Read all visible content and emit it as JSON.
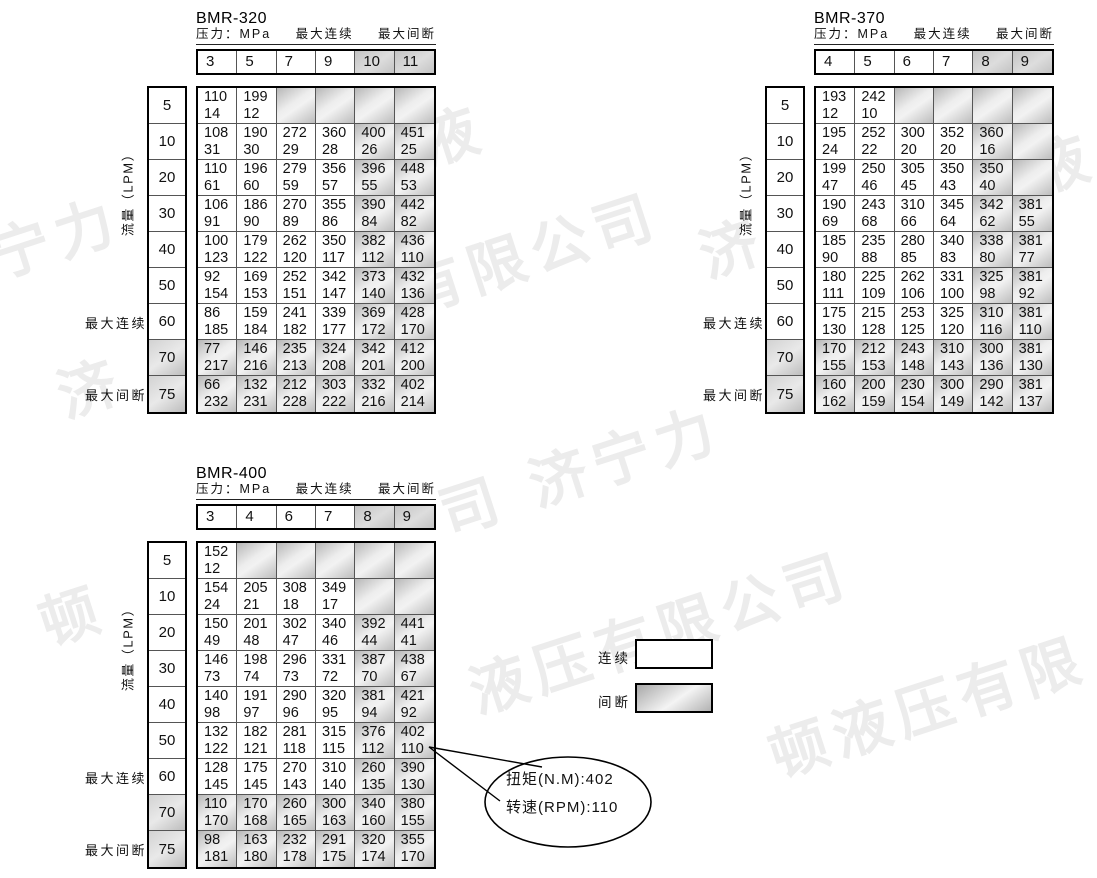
{
  "colors": {
    "table_border": "#000000",
    "grid_line": "#555555",
    "shade_gray": "#c3c3c3",
    "shade_light": "#f2f2f2",
    "watermark": "#ececec",
    "background": "#ffffff"
  },
  "watermark": {
    "text": "济宁力顿液压有限公司",
    "fragments": [
      {
        "text": "宁力",
        "left": -8,
        "top": 212
      },
      {
        "text": "济",
        "left": 58,
        "top": 352
      },
      {
        "text": "顿",
        "left": 40,
        "top": 580
      },
      {
        "text": "有限公司",
        "left": 405,
        "top": 248
      },
      {
        "text": "济",
        "left": 700,
        "top": 212
      },
      {
        "text": "液",
        "left": 420,
        "top": 100
      },
      {
        "text": "司 济宁力",
        "left": 440,
        "top": 470
      },
      {
        "text": "液压有限公司",
        "left": 470,
        "top": 648
      },
      {
        "text": "顿液压有限",
        "left": 770,
        "top": 712
      },
      {
        "text": "液",
        "left": 1030,
        "top": 128
      }
    ]
  },
  "legend": {
    "continuous_label": "连续",
    "intermittent_label": "间断"
  },
  "callout": {
    "line1": "扭矩(N.M):402",
    "line2": "转速(RPM):110"
  },
  "tables": [
    {
      "title": "BMR-320",
      "header": {
        "pressure": "压力：MPa",
        "continuous": "最大连续",
        "intermittent": "最大间断"
      },
      "flow_axis_label": "流量（LPM）",
      "left_labels": {
        "continuous": "最大连续",
        "intermittent": "最大间断"
      },
      "columns": [
        "3",
        "5",
        "7",
        "9",
        "10",
        "11"
      ],
      "shaded_columns": [
        4,
        5
      ],
      "rows": [
        {
          "flow": "5",
          "flow_shaded": false,
          "shaded": [
            2,
            3,
            4,
            5
          ],
          "cells": [
            [
              "110",
              "14"
            ],
            [
              "199",
              "12"
            ],
            null,
            null,
            null,
            null
          ]
        },
        {
          "flow": "10",
          "flow_shaded": false,
          "shaded": [
            4,
            5
          ],
          "cells": [
            [
              "108",
              "31"
            ],
            [
              "190",
              "30"
            ],
            [
              "272",
              "29"
            ],
            [
              "360",
              "28"
            ],
            [
              "400",
              "26"
            ],
            [
              "451",
              "25"
            ]
          ]
        },
        {
          "flow": "20",
          "flow_shaded": false,
          "shaded": [
            4,
            5
          ],
          "cells": [
            [
              "110",
              "61"
            ],
            [
              "196",
              "60"
            ],
            [
              "279",
              "59"
            ],
            [
              "356",
              "57"
            ],
            [
              "396",
              "55"
            ],
            [
              "448",
              "53"
            ]
          ]
        },
        {
          "flow": "30",
          "flow_shaded": false,
          "shaded": [
            4,
            5
          ],
          "cells": [
            [
              "106",
              "91"
            ],
            [
              "186",
              "90"
            ],
            [
              "270",
              "89"
            ],
            [
              "355",
              "86"
            ],
            [
              "390",
              "84"
            ],
            [
              "442",
              "82"
            ]
          ]
        },
        {
          "flow": "40",
          "flow_shaded": false,
          "shaded": [
            4,
            5
          ],
          "cells": [
            [
              "100",
              "123"
            ],
            [
              "179",
              "122"
            ],
            [
              "262",
              "120"
            ],
            [
              "350",
              "117"
            ],
            [
              "382",
              "112"
            ],
            [
              "436",
              "110"
            ]
          ]
        },
        {
          "flow": "50",
          "flow_shaded": false,
          "shaded": [
            4,
            5
          ],
          "cells": [
            [
              "92",
              "154"
            ],
            [
              "169",
              "153"
            ],
            [
              "252",
              "151"
            ],
            [
              "342",
              "147"
            ],
            [
              "373",
              "140"
            ],
            [
              "432",
              "136"
            ]
          ]
        },
        {
          "flow": "60",
          "flow_shaded": false,
          "shaded": [
            4,
            5
          ],
          "cells": [
            [
              "86",
              "185"
            ],
            [
              "159",
              "184"
            ],
            [
              "241",
              "182"
            ],
            [
              "339",
              "177"
            ],
            [
              "369",
              "172"
            ],
            [
              "428",
              "170"
            ]
          ]
        },
        {
          "flow": "70",
          "flow_shaded": true,
          "shaded": [
            0,
            1,
            2,
            3,
            4,
            5
          ],
          "cells": [
            [
              "77",
              "217"
            ],
            [
              "146",
              "216"
            ],
            [
              "235",
              "213"
            ],
            [
              "324",
              "208"
            ],
            [
              "342",
              "201"
            ],
            [
              "412",
              "200"
            ]
          ]
        },
        {
          "flow": "75",
          "flow_shaded": true,
          "shaded": [
            0,
            1,
            2,
            3,
            4,
            5
          ],
          "cells": [
            [
              "66",
              "232"
            ],
            [
              "132",
              "231"
            ],
            [
              "212",
              "228"
            ],
            [
              "303",
              "222"
            ],
            [
              "332",
              "216"
            ],
            [
              "402",
              "214"
            ]
          ]
        }
      ]
    },
    {
      "title": "BMR-370",
      "header": {
        "pressure": "压力：MPa",
        "continuous": "最大连续",
        "intermittent": "最大间断"
      },
      "flow_axis_label": "流量（LPM）",
      "left_labels": {
        "continuous": "最大连续",
        "intermittent": "最大间断"
      },
      "columns": [
        "4",
        "5",
        "6",
        "7",
        "8",
        "9"
      ],
      "shaded_columns": [
        4,
        5
      ],
      "rows": [
        {
          "flow": "5",
          "flow_shaded": false,
          "shaded": [
            2,
            3,
            4,
            5
          ],
          "cells": [
            [
              "193",
              "12"
            ],
            [
              "242",
              "10"
            ],
            null,
            null,
            null,
            null
          ]
        },
        {
          "flow": "10",
          "flow_shaded": false,
          "shaded": [
            4,
            5
          ],
          "cells": [
            [
              "195",
              "24"
            ],
            [
              "252",
              "22"
            ],
            [
              "300",
              "20"
            ],
            [
              "352",
              "20"
            ],
            [
              "360",
              "16"
            ],
            null
          ]
        },
        {
          "flow": "20",
          "flow_shaded": false,
          "shaded": [
            4,
            5
          ],
          "cells": [
            [
              "199",
              "47"
            ],
            [
              "250",
              "46"
            ],
            [
              "305",
              "45"
            ],
            [
              "350",
              "43"
            ],
            [
              "350",
              "40"
            ],
            null
          ]
        },
        {
          "flow": "30",
          "flow_shaded": false,
          "shaded": [
            4,
            5
          ],
          "cells": [
            [
              "190",
              "69"
            ],
            [
              "243",
              "68"
            ],
            [
              "310",
              "66"
            ],
            [
              "345",
              "64"
            ],
            [
              "342",
              "62"
            ],
            [
              "381",
              "55"
            ]
          ]
        },
        {
          "flow": "40",
          "flow_shaded": false,
          "shaded": [
            4,
            5
          ],
          "cells": [
            [
              "185",
              "90"
            ],
            [
              "235",
              "88"
            ],
            [
              "280",
              "85"
            ],
            [
              "340",
              "83"
            ],
            [
              "338",
              "80"
            ],
            [
              "381",
              "77"
            ]
          ]
        },
        {
          "flow": "50",
          "flow_shaded": false,
          "shaded": [
            4,
            5
          ],
          "cells": [
            [
              "180",
              "111"
            ],
            [
              "225",
              "109"
            ],
            [
              "262",
              "106"
            ],
            [
              "331",
              "100"
            ],
            [
              "325",
              "98"
            ],
            [
              "381",
              "92"
            ]
          ]
        },
        {
          "flow": "60",
          "flow_shaded": false,
          "shaded": [
            4,
            5
          ],
          "cells": [
            [
              "175",
              "130"
            ],
            [
              "215",
              "128"
            ],
            [
              "253",
              "125"
            ],
            [
              "325",
              "120"
            ],
            [
              "310",
              "116"
            ],
            [
              "381",
              "110"
            ]
          ]
        },
        {
          "flow": "70",
          "flow_shaded": true,
          "shaded": [
            0,
            1,
            2,
            3,
            4,
            5
          ],
          "cells": [
            [
              "170",
              "155"
            ],
            [
              "212",
              "153"
            ],
            [
              "243",
              "148"
            ],
            [
              "310",
              "143"
            ],
            [
              "300",
              "136"
            ],
            [
              "381",
              "130"
            ]
          ]
        },
        {
          "flow": "75",
          "flow_shaded": true,
          "shaded": [
            0,
            1,
            2,
            3,
            4,
            5
          ],
          "cells": [
            [
              "160",
              "162"
            ],
            [
              "200",
              "159"
            ],
            [
              "230",
              "154"
            ],
            [
              "300",
              "149"
            ],
            [
              "290",
              "142"
            ],
            [
              "381",
              "137"
            ]
          ]
        }
      ]
    },
    {
      "title": "BMR-400",
      "header": {
        "pressure": "压力：MPa",
        "continuous": "最大连续",
        "intermittent": "最大间断"
      },
      "flow_axis_label": "流量（LPM）",
      "left_labels": {
        "continuous": "最大连续",
        "intermittent": "最大间断"
      },
      "columns": [
        "3",
        "4",
        "6",
        "7",
        "8",
        "9"
      ],
      "shaded_columns": [
        4,
        5
      ],
      "rows": [
        {
          "flow": "5",
          "flow_shaded": false,
          "shaded": [
            1,
            2,
            3,
            4,
            5
          ],
          "cells": [
            [
              "152",
              "12"
            ],
            null,
            null,
            null,
            null,
            null
          ]
        },
        {
          "flow": "10",
          "flow_shaded": false,
          "shaded": [
            4,
            5
          ],
          "cells": [
            [
              "154",
              "24"
            ],
            [
              "205",
              "21"
            ],
            [
              "308",
              "18"
            ],
            [
              "349",
              "17"
            ],
            null,
            null
          ]
        },
        {
          "flow": "20",
          "flow_shaded": false,
          "shaded": [
            4,
            5
          ],
          "cells": [
            [
              "150",
              "49"
            ],
            [
              "201",
              "48"
            ],
            [
              "302",
              "47"
            ],
            [
              "340",
              "46"
            ],
            [
              "392",
              "44"
            ],
            [
              "441",
              "41"
            ]
          ]
        },
        {
          "flow": "30",
          "flow_shaded": false,
          "shaded": [
            4,
            5
          ],
          "cells": [
            [
              "146",
              "73"
            ],
            [
              "198",
              "74"
            ],
            [
              "296",
              "73"
            ],
            [
              "331",
              "72"
            ],
            [
              "387",
              "70"
            ],
            [
              "438",
              "67"
            ]
          ]
        },
        {
          "flow": "40",
          "flow_shaded": false,
          "shaded": [
            4,
            5
          ],
          "cells": [
            [
              "140",
              "98"
            ],
            [
              "191",
              "97"
            ],
            [
              "290",
              "96"
            ],
            [
              "320",
              "95"
            ],
            [
              "381",
              "94"
            ],
            [
              "421",
              "92"
            ]
          ]
        },
        {
          "flow": "50",
          "flow_shaded": false,
          "shaded": [
            4,
            5
          ],
          "cells": [
            [
              "132",
              "122"
            ],
            [
              "182",
              "121"
            ],
            [
              "281",
              "118"
            ],
            [
              "315",
              "115"
            ],
            [
              "376",
              "112"
            ],
            [
              "402",
              "110"
            ]
          ]
        },
        {
          "flow": "60",
          "flow_shaded": false,
          "shaded": [
            4,
            5
          ],
          "cells": [
            [
              "128",
              "145"
            ],
            [
              "175",
              "145"
            ],
            [
              "270",
              "143"
            ],
            [
              "310",
              "140"
            ],
            [
              "260",
              "135"
            ],
            [
              "390",
              "130"
            ]
          ]
        },
        {
          "flow": "70",
          "flow_shaded": true,
          "shaded": [
            0,
            1,
            2,
            3,
            4,
            5
          ],
          "cells": [
            [
              "110",
              "170"
            ],
            [
              "170",
              "168"
            ],
            [
              "260",
              "165"
            ],
            [
              "300",
              "163"
            ],
            [
              "340",
              "160"
            ],
            [
              "380",
              "155"
            ]
          ]
        },
        {
          "flow": "75",
          "flow_shaded": true,
          "shaded": [
            0,
            1,
            2,
            3,
            4,
            5
          ],
          "cells": [
            [
              "98",
              "181"
            ],
            [
              "163",
              "180"
            ],
            [
              "232",
              "178"
            ],
            [
              "291",
              "175"
            ],
            [
              "320",
              "174"
            ],
            [
              "355",
              "170"
            ]
          ]
        }
      ]
    }
  ]
}
